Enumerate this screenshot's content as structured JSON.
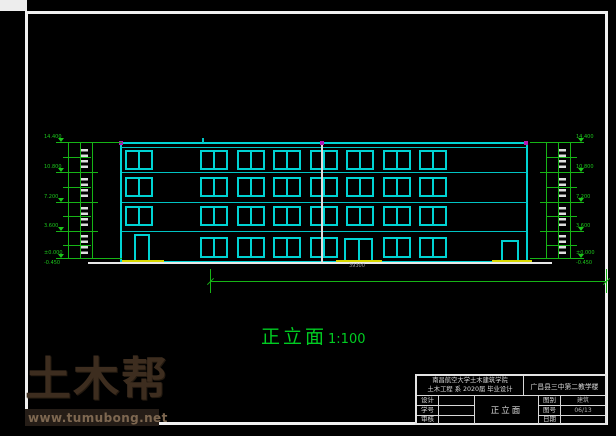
{
  "watermark": {
    "brand": "土木帮",
    "url": "www.tumubong.net"
  },
  "elevation": {
    "title": "正立面",
    "scale": "1:100",
    "total_width_dim": "39300",
    "geometry": {
      "building": {
        "left": 120,
        "right": 528,
        "top": 142,
        "cap_y": 147,
        "ground": 263
      },
      "floor_lines": [
        172,
        201.5,
        231
      ],
      "window_w": 28,
      "window_rows": [
        {
          "y": 150,
          "h": 20,
          "xs": [
            125,
            200,
            236.5,
            273,
            309.5,
            346,
            382.5,
            419
          ]
        },
        {
          "y": 177,
          "h": 20,
          "xs": [
            125,
            200,
            236.5,
            273,
            309.5,
            346,
            382.5,
            419
          ]
        },
        {
          "y": 206,
          "h": 20,
          "xs": [
            125,
            200,
            236.5,
            273,
            309.5,
            346,
            382.5,
            419
          ]
        },
        {
          "y": 237,
          "h": 21,
          "xs": [
            200,
            236.5,
            273,
            309.5,
            382.5,
            419
          ]
        }
      ],
      "doors": [
        {
          "x": 134,
          "y": 234,
          "w": 16,
          "h": 28,
          "double": false
        },
        {
          "x": 344,
          "y": 238,
          "w": 29,
          "h": 24,
          "double": true
        },
        {
          "x": 501,
          "y": 240,
          "w": 18,
          "h": 22,
          "double": false
        }
      ],
      "steps": [
        {
          "x": 122,
          "w": 42
        },
        {
          "x": 336,
          "w": 46
        },
        {
          "x": 492,
          "w": 40
        }
      ],
      "step_y": 259.5,
      "ground_line": {
        "x1": 88,
        "x2": 552,
        "y": 262
      },
      "grid_line": {
        "x": 321,
        "y1": 143,
        "y2": 263
      },
      "grid_dots_x": [
        119,
        320,
        524
      ],
      "grid_tick_x": 202
    },
    "dim_columns": {
      "top": 142,
      "bottom": 259,
      "levels_y": [
        142,
        172,
        201.5,
        231,
        258
      ],
      "minor_y": [
        157,
        187,
        216,
        245
      ],
      "labels": [
        "14.400",
        "10.800",
        "7.200",
        "3.600",
        "±0.000"
      ],
      "base_extra": "-0.450",
      "dash_y": [
        149,
        178,
        207,
        235
      ],
      "left": {
        "x_lines": [
          68,
          80,
          92
        ],
        "tick_x1": 56,
        "tick_x2": 98,
        "tick_long_x2": 122,
        "dash_x": 81,
        "label_x": 44,
        "tri_x": 58
      },
      "right": {
        "x_lines": [
          546,
          558,
          570
        ],
        "tick_x1": 540,
        "tick_x2": 584,
        "tick_long_x1": 530,
        "dash_x": 559,
        "label_x": 576,
        "tri_x": 578
      }
    },
    "bottom_dim": {
      "y": 281,
      "x1": 210,
      "x2": 606,
      "tick_y": 269,
      "tick_h": 24,
      "text_x": 349,
      "text_y": 264
    }
  },
  "title_block": {
    "school_line1": "南昌航空大学土木建筑学院",
    "school_line2": "土木工程 系 2020届 毕业设计",
    "project": "广昌县三中第二教学楼",
    "drawing_name": "正立面",
    "rows": [
      {
        "label": "设计",
        "value": "",
        "label2": "图别",
        "value2": "建筑"
      },
      {
        "label": "学号",
        "value": "",
        "label2": "图号",
        "value2": "06/13"
      },
      {
        "label": "审核",
        "value": "",
        "label2": "日期",
        "value2": ""
      }
    ]
  }
}
